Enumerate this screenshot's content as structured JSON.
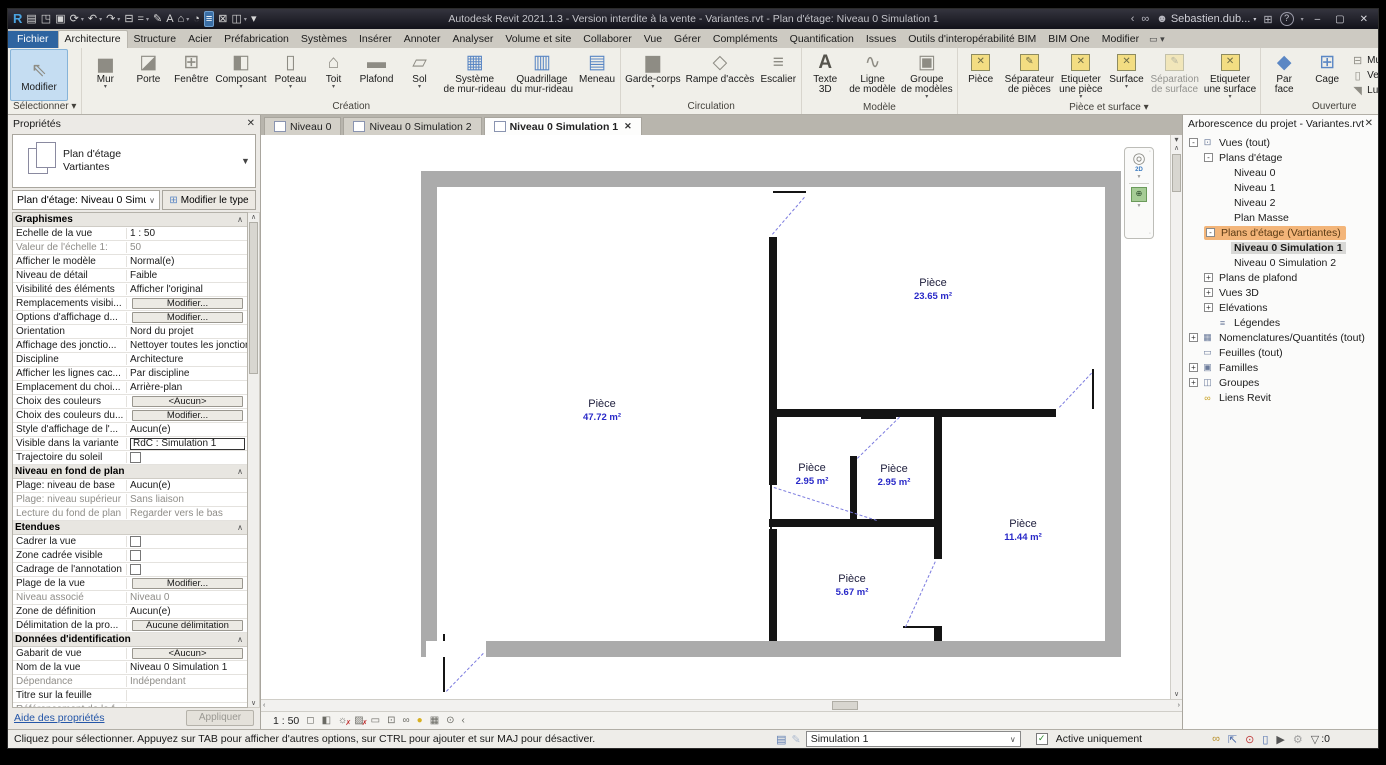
{
  "window": {
    "title": "Autodesk Revit 2021.1.3 - Version interdite à la vente - Variantes.rvt - Plan d'étage: Niveau 0 Simulation 1",
    "user": "Sebastien.dub...",
    "qat": [
      {
        "name": "app-menu",
        "glyph": "R",
        "cls": "q-logo"
      },
      {
        "name": "home",
        "glyph": "▤"
      },
      {
        "name": "open",
        "glyph": "◳"
      },
      {
        "name": "save",
        "glyph": "▣"
      },
      {
        "name": "sync-with-central",
        "glyph": "⟳",
        "arrow": true
      },
      {
        "name": "undo",
        "glyph": "↶",
        "arrow": true
      },
      {
        "name": "redo",
        "glyph": "↷",
        "arrow": true
      },
      {
        "name": "print",
        "glyph": "⊟"
      },
      {
        "name": "measure",
        "glyph": "=",
        "arrow": true
      },
      {
        "name": "aligned-dimension",
        "glyph": "✎"
      },
      {
        "name": "text",
        "glyph": "A"
      },
      {
        "name": "default-3d-view",
        "glyph": "⌂",
        "arrow": true
      },
      {
        "name": "section",
        "glyph": "◔"
      },
      {
        "name": "thin-lines",
        "glyph": "≡",
        "cls": "q-active"
      },
      {
        "name": "close-hidden-windows",
        "glyph": "⊠"
      },
      {
        "name": "switch-windows",
        "glyph": "◫",
        "arrow": true
      },
      {
        "name": "customize-qat",
        "glyph": "▾"
      }
    ],
    "controls": {
      "minimize": "–",
      "restore": "▢",
      "close": "✕"
    }
  },
  "ribbon_tabs": {
    "items": [
      {
        "label": "Fichier",
        "type": "file"
      },
      {
        "label": "Architecture",
        "type": "active"
      },
      {
        "label": "Structure"
      },
      {
        "label": "Acier"
      },
      {
        "label": "Préfabrication"
      },
      {
        "label": "Systèmes"
      },
      {
        "label": "Insérer"
      },
      {
        "label": "Annoter"
      },
      {
        "label": "Analyser"
      },
      {
        "label": "Volume et site"
      },
      {
        "label": "Collaborer"
      },
      {
        "label": "Vue"
      },
      {
        "label": "Gérer"
      },
      {
        "label": "Compléments"
      },
      {
        "label": "Quantification"
      },
      {
        "label": "Issues"
      },
      {
        "label": "Outils d'interopérabilité BIM"
      },
      {
        "label": "BIM One"
      },
      {
        "label": "Modifier"
      }
    ]
  },
  "ribbon": {
    "panels": [
      {
        "label": "Sélectionner ▾",
        "name": "select",
        "large": [
          {
            "name": "modify",
            "lines": [
              "Modifier"
            ],
            "glyph": "⇖",
            "selected": true
          }
        ]
      },
      {
        "label": "Création",
        "name": "creation",
        "large": [
          {
            "name": "wall",
            "lines": [
              "Mur"
            ],
            "glyph": "▅",
            "arrow": true
          },
          {
            "name": "door",
            "lines": [
              "Porte"
            ],
            "glyph": "◪"
          },
          {
            "name": "window",
            "lines": [
              "Fenêtre"
            ],
            "glyph": "⊞"
          },
          {
            "name": "component",
            "lines": [
              "Composant"
            ],
            "glyph": "◧",
            "arrow": true
          },
          {
            "name": "column",
            "lines": [
              "Poteau"
            ],
            "glyph": "▯",
            "arrow": true
          },
          {
            "name": "roof",
            "lines": [
              "Toit"
            ],
            "glyph": "⌂",
            "arrow": true
          },
          {
            "name": "ceiling",
            "lines": [
              "Plafond"
            ],
            "glyph": "▬"
          },
          {
            "name": "floor",
            "lines": [
              "Sol"
            ],
            "glyph": "▱",
            "arrow": true
          },
          {
            "name": "curtain-system",
            "lines": [
              "Système",
              "de mur-rideau"
            ],
            "glyph": "▦",
            "ic": "blue"
          },
          {
            "name": "curtain-grid",
            "lines": [
              "Quadrillage",
              "du mur-rideau"
            ],
            "glyph": "▥",
            "ic": "blue"
          },
          {
            "name": "mullion",
            "lines": [
              "Meneau"
            ],
            "glyph": "▤",
            "ic": "blue"
          }
        ]
      },
      {
        "label": "Circulation",
        "name": "circulation",
        "large": [
          {
            "name": "railing",
            "lines": [
              "Garde-corps"
            ],
            "glyph": "▆",
            "arrow": true
          },
          {
            "name": "ramp",
            "lines": [
              "Rampe d'accès"
            ],
            "glyph": "◇"
          },
          {
            "name": "stair",
            "lines": [
              "Escalier"
            ],
            "glyph": "≡"
          }
        ]
      },
      {
        "label": "Modèle",
        "name": "model",
        "large": [
          {
            "name": "model-text",
            "lines": [
              "Texte",
              "3D"
            ],
            "glyph": "A",
            "ic": "dark"
          },
          {
            "name": "model-line",
            "lines": [
              "Ligne",
              "de modèle"
            ],
            "glyph": "∿"
          },
          {
            "name": "model-group",
            "lines": [
              "Groupe",
              "de modèles"
            ],
            "glyph": "▣",
            "arrow": true
          }
        ]
      },
      {
        "label": "Pièce et surface ▾",
        "name": "room-area",
        "large": [
          {
            "name": "room",
            "lines": [
              "Pièce"
            ],
            "room": "✕"
          },
          {
            "name": "room-separator",
            "lines": [
              "Séparateur",
              "de pièces"
            ],
            "room": "✎"
          },
          {
            "name": "tag-room",
            "lines": [
              "Etiqueter",
              "une pièce"
            ],
            "room": "✕",
            "arrow": true
          },
          {
            "name": "area",
            "lines": [
              "Surface"
            ],
            "room": "✕",
            "arrow": true
          },
          {
            "name": "area-boundary",
            "lines": [
              "Séparation",
              "de surface"
            ],
            "room": "✎",
            "disabled": true
          },
          {
            "name": "tag-area",
            "lines": [
              "Etiqueter",
              "une surface"
            ],
            "room": "✕",
            "arrow": true
          }
        ]
      },
      {
        "label": "Ouverture",
        "name": "opening",
        "large": [
          {
            "name": "opening-by-face",
            "lines": [
              "Par",
              "face"
            ],
            "glyph": "◆",
            "ic": "blue"
          },
          {
            "name": "shaft-opening",
            "lines": [
              "Cage"
            ],
            "glyph": "⊞",
            "ic": "blue"
          }
        ],
        "small": [
          {
            "name": "wall-opening",
            "label": "Mur",
            "glyph": "⊟"
          },
          {
            "name": "vertical-opening",
            "label": "Vertical",
            "glyph": "▯"
          },
          {
            "name": "dormer-opening",
            "label": "Lucarne",
            "glyph": "◥"
          }
        ]
      },
      {
        "label": "Référence",
        "name": "reference",
        "small": [
          {
            "name": "level",
            "label": "Niveau",
            "glyph": "≐",
            "disabled": true
          },
          {
            "name": "grid",
            "label": "Quadrillage",
            "glyph": "#"
          }
        ]
      },
      {
        "label": "Plan de construction",
        "name": "work-plane",
        "large": [
          {
            "name": "set-work-plane",
            "lines": [
              "Définir"
            ],
            "glyph": "▦",
            "ic": "green"
          }
        ],
        "small": [
          {
            "name": "show-work-plane",
            "label": "Afficher",
            "glyph": "⊞"
          },
          {
            "name": "reference-plane",
            "label": "Plan de référence",
            "glyph": "◿"
          },
          {
            "name": "work-plane-viewer",
            "label": "Visionneuse",
            "glyph": "◫"
          }
        ]
      }
    ]
  },
  "properties": {
    "title": "Propriétés",
    "type_selector": {
      "line1": "Plan d'étage",
      "line2": "Vartiantes"
    },
    "instance_selector": "Plan d'étage: Niveau 0 Simulation 1",
    "modify_type_label": "Modifier le type",
    "sections": [
      {
        "title": "Graphismes",
        "rows": [
          {
            "n": "Echelle de la vue",
            "v": "1 : 50",
            "k": "t"
          },
          {
            "n": "Valeur de l'échelle  1:",
            "v": "50",
            "k": "t",
            "gn": true,
            "gv": true
          },
          {
            "n": "Afficher le modèle",
            "v": "Normal(e)",
            "k": "t"
          },
          {
            "n": "Niveau de détail",
            "v": "Faible",
            "k": "t"
          },
          {
            "n": "Visibilité des éléments",
            "v": "Afficher l'original",
            "k": "t"
          },
          {
            "n": "Remplacements visibi...",
            "v": "Modifier...",
            "k": "b"
          },
          {
            "n": "Options d'affichage d...",
            "v": "Modifier...",
            "k": "b"
          },
          {
            "n": "Orientation",
            "v": "Nord du projet",
            "k": "t"
          },
          {
            "n": "Affichage des jonctio...",
            "v": "Nettoyer toutes les jonctions de...",
            "k": "t"
          },
          {
            "n": "Discipline",
            "v": "Architecture",
            "k": "t"
          },
          {
            "n": "Afficher les lignes cac...",
            "v": "Par discipline",
            "k": "t"
          },
          {
            "n": "Emplacement du choi...",
            "v": "Arrière-plan",
            "k": "t"
          },
          {
            "n": "Choix des couleurs",
            "v": "<Aucun>",
            "k": "b"
          },
          {
            "n": "Choix des couleurs du...",
            "v": "Modifier...",
            "k": "b"
          },
          {
            "n": "Style d'affichage de l'...",
            "v": "Aucun(e)",
            "k": "t"
          },
          {
            "n": "Visible dans la variante",
            "v": "RdC : Simulation 1",
            "k": "f"
          },
          {
            "n": "Trajectoire du soleil",
            "v": "",
            "k": "c"
          }
        ]
      },
      {
        "title": "Niveau en fond de plan",
        "rows": [
          {
            "n": "Plage: niveau de base",
            "v": "Aucun(e)",
            "k": "t"
          },
          {
            "n": "Plage: niveau supérieur",
            "v": "Sans liaison",
            "k": "t",
            "gn": true,
            "gv": true
          },
          {
            "n": "Lecture du fond de plan",
            "v": "Regarder vers le bas",
            "k": "t",
            "gn": true,
            "gv": true
          }
        ]
      },
      {
        "title": "Etendues",
        "rows": [
          {
            "n": "Cadrer la vue",
            "v": "",
            "k": "c"
          },
          {
            "n": "Zone cadrée visible",
            "v": "",
            "k": "c"
          },
          {
            "n": "Cadrage de l'annotation",
            "v": "",
            "k": "c"
          },
          {
            "n": "Plage de la vue",
            "v": "Modifier...",
            "k": "b"
          },
          {
            "n": "Niveau associé",
            "v": "Niveau 0",
            "k": "t",
            "gn": true,
            "gv": true
          },
          {
            "n": "Zone de définition",
            "v": "Aucun(e)",
            "k": "t"
          },
          {
            "n": "Délimitation de la pro...",
            "v": "Aucune délimitation",
            "k": "b"
          }
        ]
      },
      {
        "title": "Données d'identification",
        "rows": [
          {
            "n": "Gabarit de vue",
            "v": "<Aucun>",
            "k": "b"
          },
          {
            "n": "Nom de la vue",
            "v": "Niveau 0 Simulation 1",
            "k": "t"
          },
          {
            "n": "Dépendance",
            "v": "Indépendant",
            "k": "t",
            "gn": true,
            "gv": true
          },
          {
            "n": "Titre sur la feuille",
            "v": "",
            "k": "t"
          },
          {
            "n": "Référencement de la f...",
            "v": "",
            "k": "t",
            "gn": true
          },
          {
            "n": "Référencement du dét...",
            "v": "",
            "k": "t",
            "gn": true
          }
        ]
      },
      {
        "title": "Phase de construction",
        "rows": [
          {
            "n": "Filtre des phases",
            "v": "Afficher tout",
            "k": "t"
          }
        ]
      }
    ],
    "help_link": "Aide des propriétés",
    "apply_label": "Appliquer"
  },
  "view_tabs": {
    "items": [
      {
        "label": "Niveau 0"
      },
      {
        "label": "Niveau 0 Simulation 2"
      },
      {
        "label": "Niveau 0 Simulation 1",
        "active": true,
        "close": "✕"
      }
    ]
  },
  "plan": {
    "rooms": [
      {
        "name": "Pièce",
        "area": "23.65 m²",
        "x": 512,
        "y": 119
      },
      {
        "name": "Pièce",
        "area": "47.72 m²",
        "x": 181,
        "y": 240
      },
      {
        "name": "Pièce",
        "area": "2.95 m²",
        "x": 391,
        "y": 304
      },
      {
        "name": "Pièce",
        "area": "2.95 m²",
        "x": 473,
        "y": 305
      },
      {
        "name": "Pièce",
        "area": "11.44 m²",
        "x": 602,
        "y": 360
      },
      {
        "name": "Pièce",
        "area": "5.67 m²",
        "x": 431,
        "y": 415
      }
    ]
  },
  "project_browser": {
    "title": "Arborescence du projet - Variantes.rvt",
    "items": [
      {
        "label": "Vues (tout)",
        "level": 0,
        "exp": "-",
        "icon": "views"
      },
      {
        "label": "Plans d'étage",
        "level": 1,
        "exp": "-"
      },
      {
        "label": "Niveau 0",
        "level": 2
      },
      {
        "label": "Niveau 1",
        "level": 2
      },
      {
        "label": "Niveau 2",
        "level": 2
      },
      {
        "label": "Plan Masse",
        "level": 2
      },
      {
        "label": "Plans d'étage (Vartiantes)",
        "level": 1,
        "exp": "-",
        "highlight": true
      },
      {
        "label": "Niveau 0 Simulation 1",
        "level": 2,
        "selected": true
      },
      {
        "label": "Niveau 0 Simulation 2",
        "level": 2
      },
      {
        "label": "Plans de plafond",
        "level": 1,
        "exp": "+"
      },
      {
        "label": "Vues 3D",
        "level": 1,
        "exp": "+"
      },
      {
        "label": "Elévations",
        "level": 1,
        "exp": "+"
      },
      {
        "label": "Légendes",
        "level": 1,
        "icon": "legend"
      },
      {
        "label": "Nomenclatures/Quantités (tout)",
        "level": 0,
        "exp": "+",
        "icon": "schedule"
      },
      {
        "label": "Feuilles (tout)",
        "level": 0,
        "icon": "sheet"
      },
      {
        "label": "Familles",
        "level": 0,
        "exp": "+",
        "icon": "family"
      },
      {
        "label": "Groupes",
        "level": 0,
        "exp": "+",
        "icon": "group"
      },
      {
        "label": "Liens Revit",
        "level": 0,
        "icon": "link"
      }
    ]
  },
  "view_control_bar": {
    "scale": "1 : 50",
    "icons": [
      {
        "name": "visual-style",
        "glyph": "◻"
      },
      {
        "name": "detail-level",
        "glyph": "◧"
      },
      {
        "name": "sun-path",
        "glyph": "☼",
        "redx": true
      },
      {
        "name": "shadows",
        "glyph": "▨",
        "redx": true
      },
      {
        "name": "crop-region",
        "glyph": "▭"
      },
      {
        "name": "show-crop-region",
        "glyph": "⊡"
      },
      {
        "name": "temporary-hide-isolate",
        "glyph": "∞"
      },
      {
        "name": "reveal-hidden-elements",
        "glyph": "●",
        "bulb": true
      },
      {
        "name": "worksharing-display",
        "glyph": "▦"
      },
      {
        "name": "constraints",
        "glyph": "⊙"
      },
      {
        "name": "collapse",
        "glyph": "‹"
      }
    ]
  },
  "status_bar": {
    "message": "Cliquez pour sélectionner. Appuyez sur TAB pour afficher d'autres options, sur CTRL pour ajouter et sur MAJ pour désactiver.",
    "mid_icons": [
      {
        "name": "manage-variants",
        "glyph": "▤"
      },
      {
        "name": "add-to-variant-set",
        "glyph": "✎",
        "disabled": true
      }
    ],
    "variant_value": "Simulation 1",
    "checkbox_label": "Active uniquement",
    "checkbox_checked": true,
    "right_icons": [
      {
        "name": "select-links",
        "glyph": "∞",
        "color": "#b8902a"
      },
      {
        "name": "select-underlay-elements",
        "glyph": "⇱",
        "color": "#4a6aaa"
      },
      {
        "name": "select-pinned-elements",
        "glyph": "⊙",
        "color": "#c04040"
      },
      {
        "name": "select-elements-by-face",
        "glyph": "▯",
        "color": "#4a6aaa"
      },
      {
        "name": "drag-elements-on-selection",
        "glyph": "▶",
        "color": "#555555"
      },
      {
        "name": "reveal-hidden",
        "glyph": "⚙",
        "color": "#a0a0a0"
      },
      {
        "name": "selection-filter",
        "glyph": "▽",
        "color": "#555555"
      }
    ],
    "filter_count": ":0"
  },
  "titlebar_right": [
    {
      "name": "collapse",
      "glyph": "‹"
    },
    {
      "name": "search",
      "glyph": "∞"
    }
  ],
  "colors": {
    "highlight_orange": "#f3b579",
    "room_area_blue": "#2929c8",
    "dashed_blue": "#7b7bdf",
    "wall_black": "#141414",
    "plan_gray": "#ababab",
    "accent_blue_tab": "#2e64a0"
  }
}
